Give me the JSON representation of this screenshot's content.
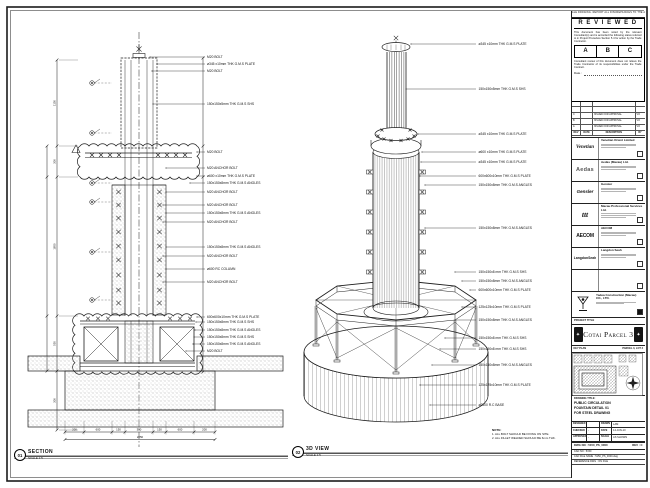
{
  "sheet": {
    "top_strip": "DO NOT SCALE DRAWING. REPORT ALL DISCREPANCIES TO THE ARCHITECT."
  },
  "reviewed": {
    "title": "R E V I E W E D",
    "para1": "This document has been noted by the relevant Consultant(s) and is accorded the following status referred to in Project Procedure Section 5.4 for action by the Trade Contractor.",
    "options": [
      "A",
      "B",
      "C"
    ],
    "para2": "Consultant review of this document does not relieve the Trade Contractor of its responsibilities under the Trade Contract.",
    "date_label": "Date :"
  },
  "revision_table": {
    "headers": [
      "REV",
      "DATE",
      "DESCRIPTION",
      "BY"
    ],
    "rows": [
      {
        "rev": "C",
        "date": "",
        "desc": "ISSUED FOR APPROVAL",
        "by": "VO"
      },
      {
        "rev": "B",
        "date": "",
        "desc": "ISSUED FOR APPROVAL",
        "by": "VO"
      },
      {
        "rev": "A",
        "date": "",
        "desc": "ISSUED FOR APPROVAL",
        "by": "VO"
      }
    ]
  },
  "companies": [
    {
      "logo": "Venetian",
      "name": "Venetian Orient Limited"
    },
    {
      "logo": "Aedas",
      "name": "Aedas (Macau) Ltd."
    },
    {
      "logo": "Gensler",
      "name": "Gensler"
    },
    {
      "logo": "ttt",
      "name": "Macau Professional Services Ltd."
    },
    {
      "logo": "AECOM",
      "name": "AECOM"
    },
    {
      "logo": "LangdonSeah",
      "name": "Langdon Seah"
    },
    {
      "logo": "",
      "name": ""
    }
  ],
  "contractor": {
    "name": "Yadea Construction (Macau) CO., LTD."
  },
  "project": {
    "label": "PROJECT TITLE",
    "title": "Cotai Parcel 3"
  },
  "key_plan": {
    "label": "KEY PLAN",
    "area": "PARCEL 3, LOT 2"
  },
  "drawing": {
    "title_label": "DRAWING TITLE:",
    "title_lines": [
      "PUBLIC CIRCULATION",
      "FOUNTAIN DETAIL 01",
      "FOR STEEL DRAWING"
    ],
    "fields": [
      [
        "DESIGNED",
        "",
        "DRAWN",
        "LAM"
      ],
      [
        "CHECKED",
        "-",
        "DATE",
        "14-JUN-10"
      ],
      [
        "APPROVED",
        "-",
        "SCALE",
        "AS SHOWN"
      ]
    ],
    "dwg_label": "DWG NO : 5150_PS_0000",
    "rev_label": "REV : C",
    "cad_rows": [
      "CAD NO : 5150",
      "CAD FILE NAME : 5150_PS_0000.dwg",
      "REFERENCE DWG : ON FILE"
    ]
  },
  "markers": {
    "section": {
      "num": "01",
      "label": "SECTION",
      "scale": "SCALE 1:5"
    },
    "view3d": {
      "num": "02",
      "label": "3D VIEW",
      "scale": "SCALE 1:5"
    }
  },
  "note": {
    "title": "NOTE:",
    "lines": [
      "1. ALL BOLT SHOULD BE FIXING ON SITE.",
      "2. ALL FILLET WELDED SHOULD BE 6mm THK."
    ]
  },
  "section_view": {
    "callouts": [
      "M20 BOLT",
      "ø345 x10mm THK G.M.S PLATE",
      "M20 BOLT",
      "150x150x5mm THK G.M.S SHS",
      "M20 BOLT",
      "M20 ANCHOR BOLT",
      "ø600 x10mm THK G.M.S PLATE",
      "150x150x8mm THK G.M.S ANGLES",
      "M20 ANCHOR BOLT",
      "M20 ANCHOR BOLT",
      "150x150x8mm THK G.M.S ANGLES",
      "M20 ANCHOR BOLT",
      "150x150x8mm THK G.M.S ANGLES",
      "M20 ANCHOR BOLT",
      "ø600 RC COLUMN",
      "M20 ANCHOR BOLT",
      "600x600x10mm THK G.M.S PLATE",
      "150x150x8mm THK G.M.S SHS",
      "150x150x8mm THK G.M.S ANGLES",
      "150x150x8mm THK G.M.S SHS",
      "150x150x8mm THK G.M.S ANGLES",
      "M20 BOLT"
    ],
    "dims_bottom": [
      "200",
      "600",
      "150",
      "350",
      "150",
      "600",
      "200"
    ],
    "dim_total": "2250",
    "dims_left": [
      "1150",
      "300",
      "1850",
      "550",
      "300"
    ]
  },
  "view3d": {
    "callouts": [
      "ø345 x10mm THK G.M.S PLATE",
      "150x150x5mm THK G.M.S SHS",
      "ø345 x10mm THK G.M.S PLATE",
      "ø600 x10mm THK G.M.S PLATE",
      "ø345 x10mm THK G.M.S PLATE",
      "600x600x10mm THK G.M.S PLATE",
      "150x150x8mm THK G.M.S ANGLES",
      "150x150x8mm THK G.M.S ANGLES",
      "150x150x8 mm THK G.M.S SHS",
      "150x150x8mm THK G.M.S ANGLES",
      "600x600x10mm THK G.M.S PLATE",
      "125x125x10mm THK G.M.S PLATE",
      "150x150x8mm THK G.M.S ANGLES",
      "150x150x8 mm THK G.M.S SHS",
      "150x150x8 mm THK G.M.S SHS",
      "150x150x8mm THK G.M.S ANGLES",
      "125x125x10mm THK G.M.S PLATE",
      "ø2500 R.C BASE"
    ]
  }
}
